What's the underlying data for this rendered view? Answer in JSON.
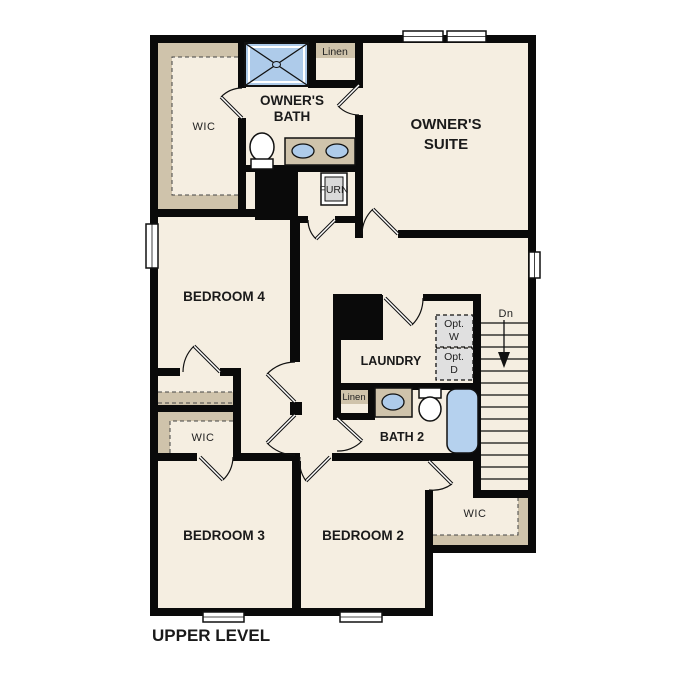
{
  "title": "UPPER LEVEL",
  "palette": {
    "background": "#ffffff",
    "floor": "#f5eee1",
    "wall": "#0a0a0a",
    "shelf_tan": "#cfc3ab",
    "fixture_blue": "#aecbea",
    "appliance_gray": "#e0e0e0"
  },
  "rooms": {
    "owners_suite": {
      "line1": "OWNER'S",
      "line2": "SUITE"
    },
    "owners_bath": {
      "line1": "OWNER'S",
      "line2": "BATH"
    },
    "owners_wic": {
      "label": "WIC"
    },
    "bedroom4": {
      "label": "BEDROOM 4"
    },
    "bedroom3": {
      "label": "BEDROOM 3"
    },
    "bedroom2": {
      "label": "BEDROOM 2"
    },
    "laundry": {
      "label": "LAUNDRY"
    },
    "bath2": {
      "label": "BATH 2"
    },
    "wic_bedroom3": {
      "label": "WIC"
    },
    "wic_bedroom2": {
      "label": "WIC"
    }
  },
  "closets": {
    "linen_top": {
      "label": "Linen"
    },
    "linen_bath2": {
      "label": "Linen"
    },
    "furnace": {
      "label": "FURN"
    }
  },
  "appliances": {
    "optional_washer": {
      "line1": "Opt.",
      "line2": "W"
    },
    "optional_dryer": {
      "line1": "Opt.",
      "line2": "D"
    }
  },
  "stairs": {
    "label": "Dn"
  }
}
